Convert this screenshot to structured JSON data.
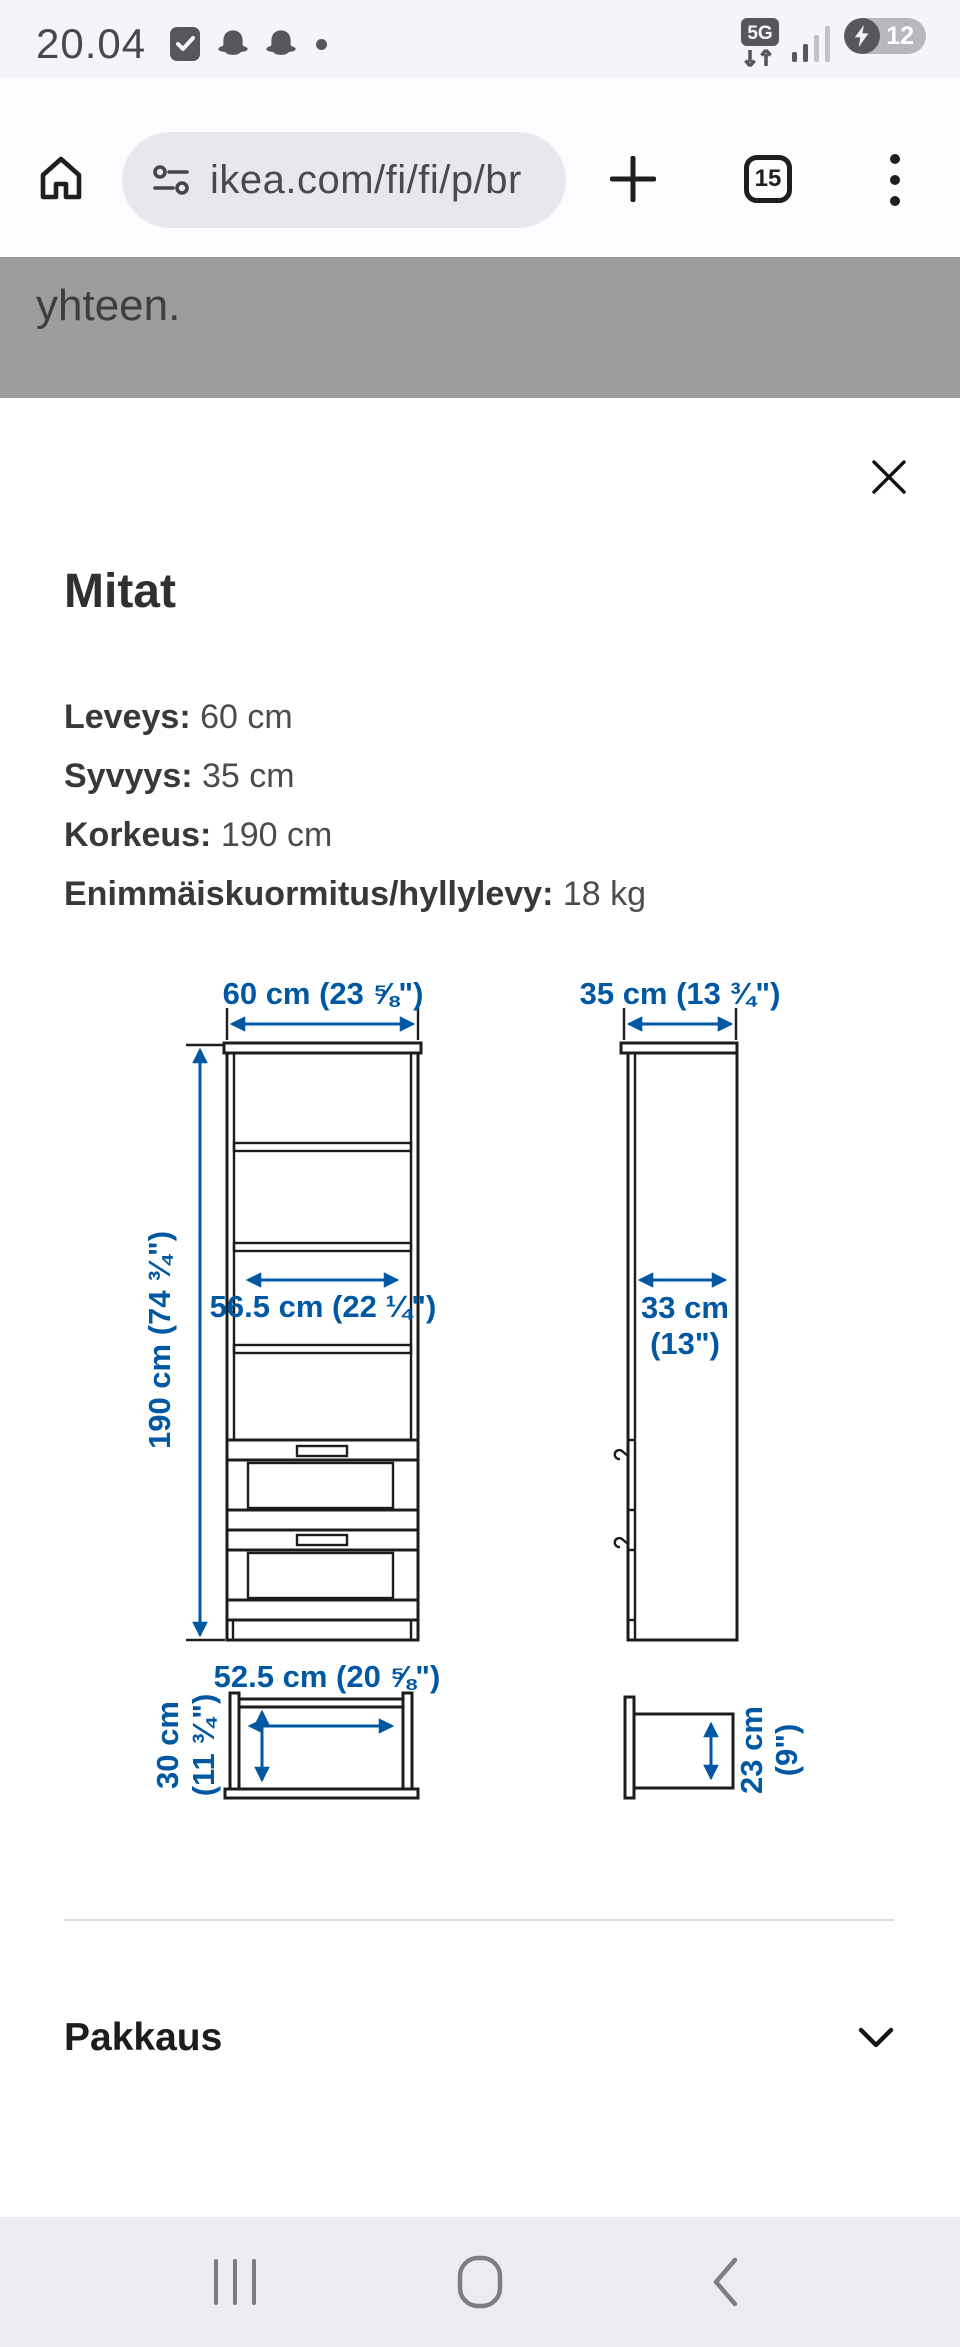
{
  "status_bar": {
    "time": "20.04",
    "network_badge": "5G",
    "battery_percent": "12",
    "left_icons": [
      "checkmark-badge",
      "snapchat-ghost",
      "snapchat-ghost",
      "notification-dot"
    ]
  },
  "browser": {
    "url": "ikea.com/fi/fi/p/br",
    "tab_count": "15"
  },
  "page_behind": {
    "visible_text": "yhteen."
  },
  "modal": {
    "title": "Mitat",
    "specs": [
      {
        "label": "Leveys:",
        "value": " 60 cm"
      },
      {
        "label": "Syvyys:",
        "value": " 35 cm"
      },
      {
        "label": "Korkeus:",
        "value": " 190 cm"
      },
      {
        "label": "Enimmäiskuormitus/hyllylevy:",
        "value": " 18 kg"
      }
    ],
    "diagram": {
      "front_width": "60 cm (23 ⅝\")",
      "front_height": "190 cm (74 ¾\")",
      "front_inner_width": "56.5 cm (22 ¼\")",
      "side_depth": "35 cm (13 ¾\")",
      "side_inner_depth_l1": "33 cm",
      "side_inner_depth_l2": "(13\")",
      "drawer_width": "52.5 cm (20 ⅝\")",
      "drawer_height_l1": "30 cm",
      "drawer_height_l2": "(11 ¾\")",
      "drawer_depth_l1": "23 cm",
      "drawer_depth_l2": "(9\")"
    },
    "accordion": {
      "label": "Pakkaus"
    }
  },
  "colors": {
    "accent_blue": "#0058a3",
    "diagram_ink": "#1c1c1c"
  }
}
